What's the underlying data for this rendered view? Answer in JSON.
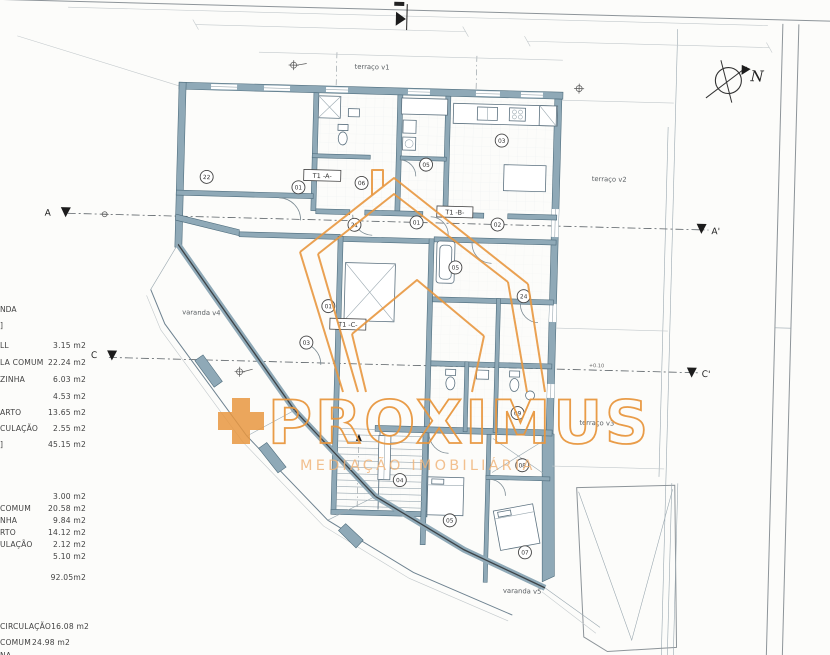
{
  "document": {
    "kind": "scanned architectural floor plan",
    "accent_color": "#e8973f",
    "wall_color": "#8fa9b7"
  },
  "watermark": {
    "plus": "+",
    "brand": "PROXIMUS",
    "tagline": "MEDIAÇÃO IMOBILIÁRIA",
    "color": "#e8973f"
  },
  "compass": {
    "north": "N"
  },
  "sections": {
    "a": "A",
    "a_prime": "A'",
    "c": "C",
    "c_prime": "C'"
  },
  "plan": {
    "labels": [
      {
        "text": "terraço v1"
      },
      {
        "text": "terraço v2"
      },
      {
        "text": "terraço v3"
      },
      {
        "text": "varanda v4"
      },
      {
        "text": "varanda v5"
      }
    ],
    "units": [
      {
        "text": "T1 -A-"
      },
      {
        "text": "T1 -B-"
      },
      {
        "text": "T1 -C-"
      }
    ],
    "bubbles": [
      {
        "n": "22"
      },
      {
        "n": "01"
      },
      {
        "n": "06"
      },
      {
        "n": "05"
      },
      {
        "n": "03"
      },
      {
        "n": "02"
      },
      {
        "n": "01"
      },
      {
        "n": "21"
      },
      {
        "n": "05"
      },
      {
        "n": "24"
      },
      {
        "n": "01"
      },
      {
        "n": "03"
      },
      {
        "n": "09"
      },
      {
        "n": "04"
      },
      {
        "n": "05"
      },
      {
        "n": "08"
      },
      {
        "n": "07"
      }
    ],
    "annotation": "+0.10"
  },
  "schedule": {
    "b1": {
      "heading": "NDA",
      "bracket": "]",
      "rows": [
        {
          "label": "LL",
          "value": "3.15 m2"
        },
        {
          "label": "LA COMUM",
          "value": "22.24 m2"
        },
        {
          "label": "ZINHA",
          "value": "6.03 m2"
        },
        {
          "label": "",
          "value": "4.53 m2"
        },
        {
          "label": "ARTO",
          "value": "13.65 m2"
        },
        {
          "label": "CULAÇÃO",
          "value": "2.55 m2"
        }
      ],
      "total": {
        "label": "]",
        "value": "45.15 m2"
      }
    },
    "b2": {
      "rows": [
        {
          "label": "",
          "value": "3.00 m2"
        },
        {
          "label": "COMUM",
          "value": "20.58 m2"
        },
        {
          "label": "NHA",
          "value": "9.84 m2"
        },
        {
          "label": "RTO",
          "value": "14.12 m2"
        },
        {
          "label": "ULAÇÃO",
          "value": "2.12 m2"
        },
        {
          "label": "",
          "value": "5.10 m2"
        }
      ],
      "total": {
        "label": "",
        "value": "92.05m2"
      }
    },
    "b3": {
      "rows": [
        {
          "label": "CIRCULAÇÃO",
          "value": "16.08 m2"
        },
        {
          "label": "COMUM",
          "value": "24.98 m2"
        },
        {
          "label": "NA",
          "value": ""
        }
      ]
    }
  }
}
